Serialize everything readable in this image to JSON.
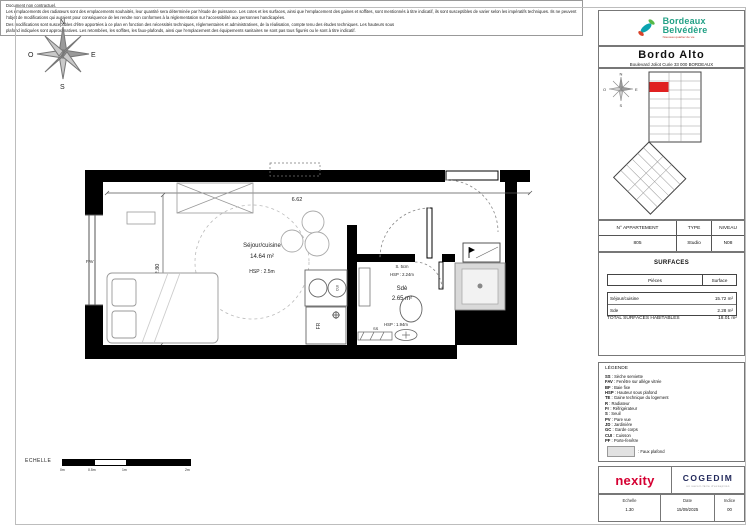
{
  "brand": {
    "name_line1": "Bordeaux",
    "name_line2": "Belvédère",
    "tagline": "Nouveau quartier de vie"
  },
  "residence": {
    "name": "Bordo Alto",
    "address": "Boulevard Joliot Curie 33 000 BORDEAUX"
  },
  "apartment": {
    "headers": {
      "number": "N° APPARTEMENT",
      "type": "TYPE",
      "level": "NIVEAU"
    },
    "values": {
      "number": "805",
      "type": "Studio",
      "level": "N08"
    }
  },
  "surfaces": {
    "title": "SURFACES",
    "col_piece": "Pièces",
    "col_surface": "Surface",
    "rows": [
      {
        "piece": "Séjour/cuisine",
        "surface": "15.72 m²"
      },
      {
        "piece": "Sde",
        "surface": "2.28 m²"
      }
    ],
    "total_label": "TOTAL SURFACES HABITABLES",
    "total_value": "18.01 m²"
  },
  "legend": {
    "title": "LÉGENDE",
    "items": [
      {
        "abbr": "SS",
        "label": "Sèche serviette"
      },
      {
        "abbr": "FAV",
        "label": "Fenêtre sur allège vitrée"
      },
      {
        "abbr": "BF",
        "label": "Baie fixe"
      },
      {
        "abbr": "HSP",
        "label": "Hauteur sous plafond"
      },
      {
        "abbr": "TE",
        "label": "Gaine technique du logement"
      },
      {
        "abbr": "R",
        "label": "Radiateur"
      },
      {
        "abbr": "Fr",
        "label": "Réfrigérateur"
      },
      {
        "abbr": "S",
        "label": "Seuil"
      },
      {
        "abbr": "PV",
        "label": "Pare vue"
      },
      {
        "abbr": "JD",
        "label": "Jardinière"
      },
      {
        "abbr": "GC",
        "label": "Garde corps"
      },
      {
        "abbr": "CUI",
        "label": "Cuisson"
      },
      {
        "abbr": "PF",
        "label": "Porte-fenêtre"
      }
    ],
    "swatch_label": "Faux plafond"
  },
  "plan": {
    "room1": {
      "name": "Séjour/cuisine",
      "area": "14.64 m²",
      "hsp": "HSP : 2.5m"
    },
    "room2": {
      "name": "Sdè",
      "area": "2.65 m²",
      "seuil": "S. 5cm",
      "hsp_upper": "HSP : 2.24m",
      "hsp_lower": "HSP : 1.94m"
    },
    "dims": {
      "width": "6.62",
      "height": "2.80"
    },
    "labels": {
      "fav": "FAV",
      "fr": "FR",
      "cui": "CUI",
      "ss": "SS"
    }
  },
  "compass": {
    "n": "N",
    "e": "E",
    "s": "S",
    "o": "O"
  },
  "scalebar": {
    "label": "ECHELLE",
    "ticks": [
      "0m",
      "0.5m",
      "1m",
      "2m"
    ]
  },
  "footer": {
    "logos": {
      "nexity": "nexity",
      "cogedim": "COGEDIM",
      "cogedim_tagline": "un savoir-faire d'exception"
    },
    "meta": {
      "echelle_label": "Echelle",
      "echelle_value": "1.30",
      "date_label": "Date",
      "date_value": "15/09/2025",
      "indice_label": "Indice",
      "indice_value": "00"
    }
  },
  "disclaimer": {
    "lines": [
      "Document non contractuel.",
      "Les emplacements des radiateurs sont des emplacements souhaités, leur quantité sera déterminée par l'étude de puissance. Les cotes et les surfaces, ainsi que l'emplacement des gaines et soffites, sont mentionnés à titre indicatif, ils sont susceptibles de varier selon les impératifs techniques. Ils ne peuvent faire",
      "l'objet de modifications qui auraient pour conséquence de les rendre non conformes à la réglementation sur l'accessibilité aux personnes handicapées.",
      "Des modifications sont susceptibles d'être apportées à ce plan en fonction des nécessités techniques, réglementaires et administratives, de la réalisation, compte tenu des études techniques. Les hauteurs sous",
      "plafond indiquées sont approximatives. Les retombées, les soffites, les faux-plafonds, ainsi que l'emplacement des équipements sanitaires ne sont pas tous figurés ou le sont à titre indicatif."
    ]
  },
  "colors": {
    "brand_teal": "#23a186",
    "nexity_red": "#d50032",
    "cogedim_navy": "#232a5c",
    "unit_red": "#e02020"
  }
}
